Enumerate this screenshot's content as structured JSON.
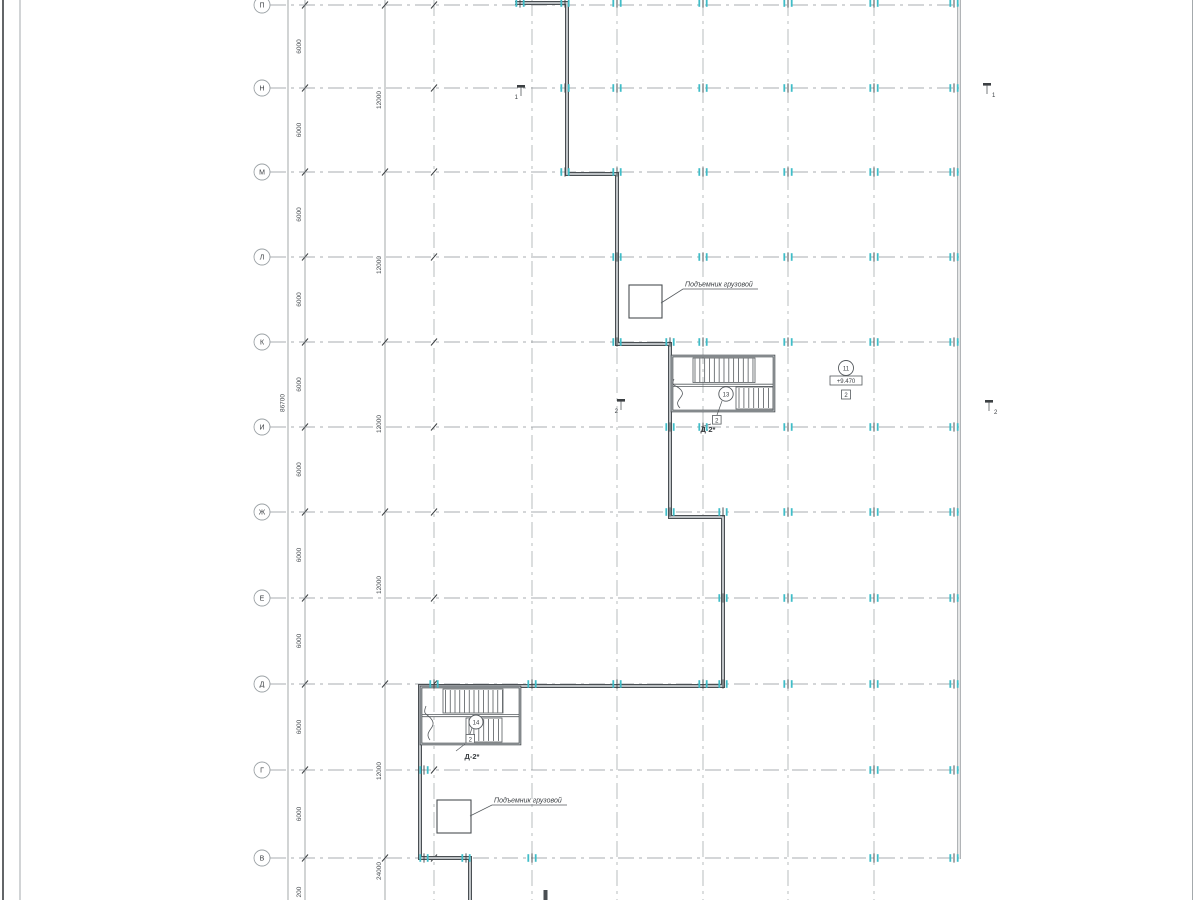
{
  "sheet": {
    "type": "architectural-floor-plan"
  },
  "colors": {
    "wall": "#4a4f53",
    "wall_fill": "#ccd0d3",
    "grid": "#9aa0a4",
    "axis_line": "#8e9296",
    "dim_line": "#7d8387",
    "tick": "#3c4043",
    "marker_teal": "#3fbdc8",
    "text": "#3a3e42"
  },
  "axes": {
    "circle_x": 262,
    "line_start_x": 270,
    "line_end_x": 959,
    "rows": [
      {
        "label": "П",
        "y": 5
      },
      {
        "label": "Н",
        "y": 88
      },
      {
        "label": "М",
        "y": 172
      },
      {
        "label": "Л",
        "y": 257
      },
      {
        "label": "К",
        "y": 342
      },
      {
        "label": "И",
        "y": 427
      },
      {
        "label": "Ж",
        "y": 512
      },
      {
        "label": "Е",
        "y": 598
      },
      {
        "label": "Д",
        "y": 684
      },
      {
        "label": "Г",
        "y": 770
      },
      {
        "label": "В",
        "y": 858
      }
    ],
    "chain12_tick_rows": [
      0,
      2,
      4,
      6,
      8,
      10
    ]
  },
  "grid": {
    "columns_x": [
      434,
      532,
      617,
      703,
      788,
      874
    ],
    "boundary_x": 959
  },
  "dimensions": {
    "chain_total": {
      "line_x": 288,
      "label": "86700",
      "label_y": 403
    },
    "chain_6000": {
      "line_x": 305,
      "label": "6000",
      "partial_label": "200",
      "partial_y": 892
    },
    "chain_12000": {
      "line_x": 385,
      "labels": [
        {
          "text": "12000",
          "y": 100
        },
        {
          "text": "12000",
          "y": 265
        },
        {
          "text": "12000",
          "y": 424
        },
        {
          "text": "12000",
          "y": 585
        },
        {
          "text": "12000",
          "y": 771
        },
        {
          "text": "24000",
          "y": 871
        }
      ]
    }
  },
  "column_markers": {
    "rows": [
      {
        "y": 3,
        "xs": [
          520,
          565,
          617,
          703,
          788,
          874,
          954
        ]
      },
      {
        "y": 88,
        "xs": [
          565,
          617,
          703,
          788,
          874,
          954
        ]
      },
      {
        "y": 172,
        "xs": [
          565,
          617,
          703,
          788,
          874,
          954
        ]
      },
      {
        "y": 257,
        "xs": [
          617,
          703,
          788,
          874,
          954
        ]
      },
      {
        "y": 342,
        "xs": [
          617,
          670,
          703,
          788,
          874,
          954
        ]
      },
      {
        "y": 427,
        "xs": [
          670,
          703,
          788,
          874,
          954
        ]
      },
      {
        "y": 512,
        "xs": [
          670,
          723,
          788,
          874,
          954
        ]
      },
      {
        "y": 598,
        "xs": [
          723,
          788,
          874,
          954
        ]
      },
      {
        "y": 684,
        "xs": [
          434,
          532,
          617,
          703,
          723,
          788,
          874,
          954
        ]
      },
      {
        "y": 770,
        "xs": [
          424,
          874,
          954
        ]
      },
      {
        "y": 858,
        "xs": [
          424,
          466,
          532,
          874,
          954
        ]
      }
    ]
  },
  "annotations": {
    "lift_upper": {
      "text": "Подъемник грузовой"
    },
    "lift_lower": {
      "text": "Подъемник грузовой"
    },
    "stair_upper": {
      "node": "13",
      "badge": "2",
      "label": "Д-2*"
    },
    "stair_lower": {
      "node": "14",
      "badge": "2",
      "label": "Д-2*"
    },
    "level": {
      "node": "11",
      "elevation": "+9.470",
      "badge": "2"
    },
    "sections": {
      "s1": "1",
      "s2": "2"
    }
  }
}
